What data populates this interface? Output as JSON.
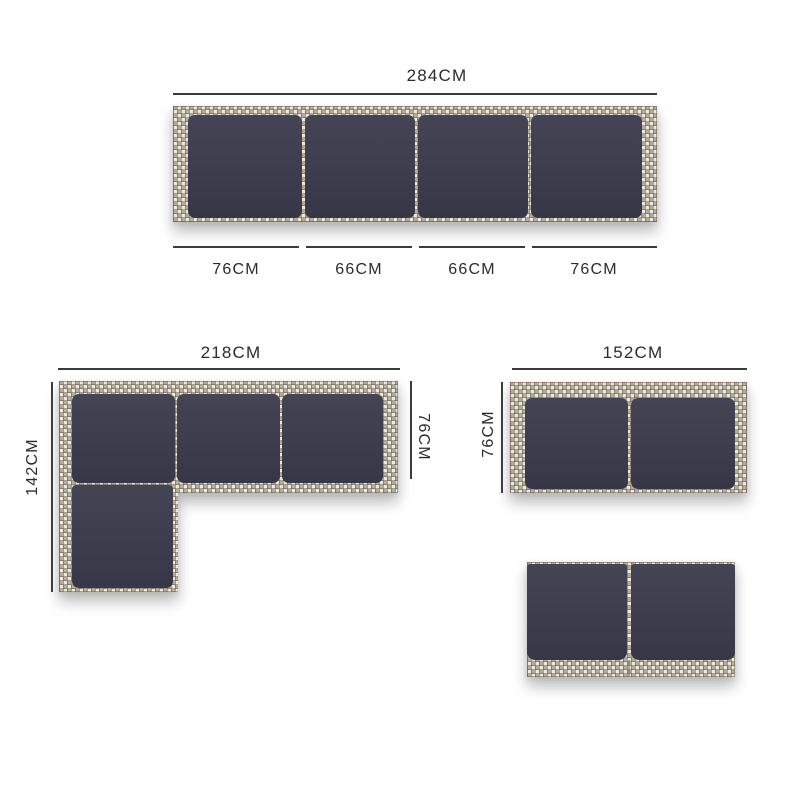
{
  "diagram_title": "garden-sofa-set-dimensions",
  "colors": {
    "background": "#ffffff",
    "cushion": "#3b3a4b",
    "rattan_light": "#ece8db",
    "rattan_dark": "#b3ac9b",
    "dimension_line": "#3b3b3b",
    "label_text": "#2b2b2b"
  },
  "units": {
    "sofa_4seat_top_view": {
      "total_width_label": "284CM",
      "segment_labels": [
        "76CM",
        "66CM",
        "66CM",
        "76CM"
      ],
      "cushion_count": 4
    },
    "corner_sofa_top_view": {
      "width_label": "218CM",
      "height_label": "142CM",
      "depth_label": "76CM",
      "cushion_count": 4
    },
    "sofa_2seat_top_view": {
      "width_label": "152CM",
      "depth_label": "76CM",
      "cushion_count": 2
    },
    "sofa_2seat_front_view": {
      "cushion_count": 2
    }
  }
}
